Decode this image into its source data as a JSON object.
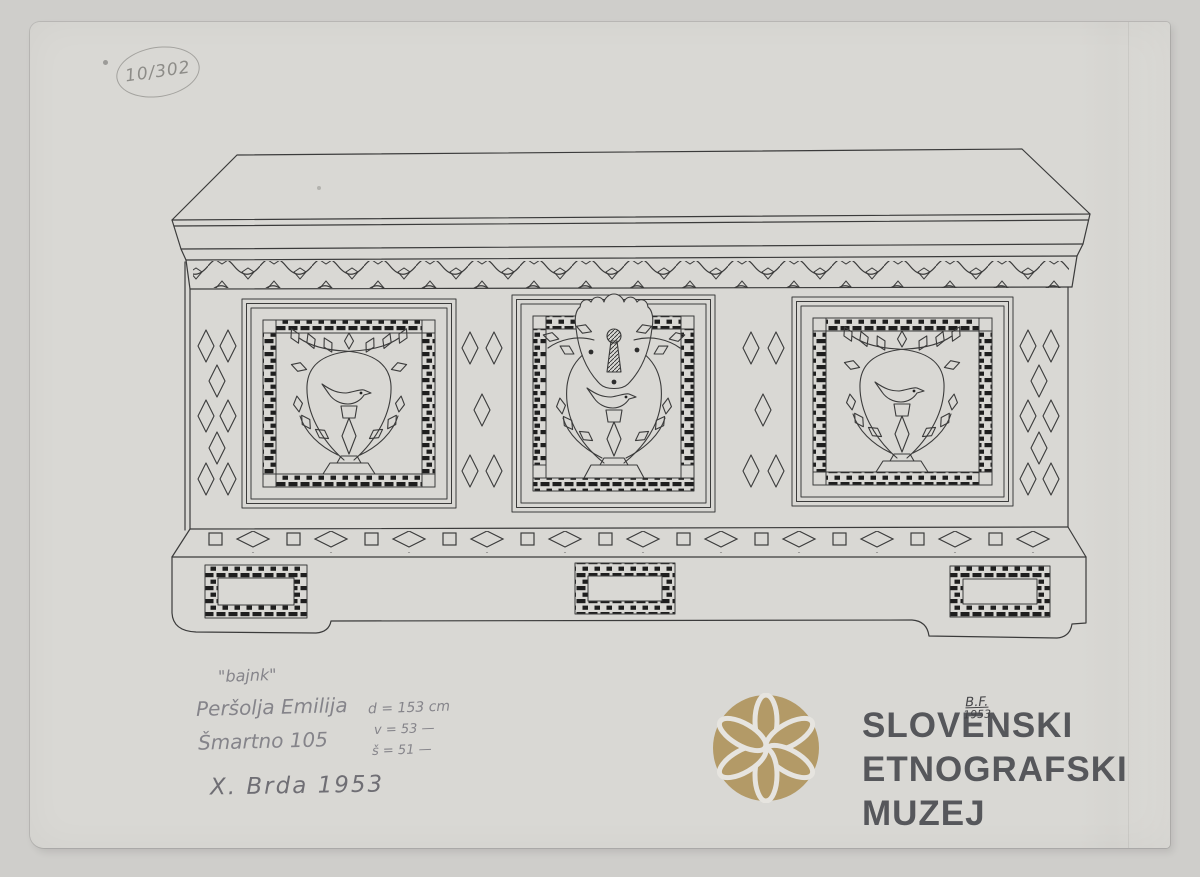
{
  "page": {
    "background": "#cfcecb",
    "paper_color": "#d9d8d4"
  },
  "archive_number": "10/302",
  "handwritten": {
    "object_name": "\"bajnk\"",
    "owner": "Peršolja Emilija",
    "address": "Šmartno 105",
    "dim_length": "d = 153 cm",
    "dim_height": "v = 53 —",
    "dim_width": "š = 51 —",
    "region_year": "X. Brda 1953",
    "initials": "B.F.",
    "initials_year": "1953",
    "pencil_color": "#85848a"
  },
  "logo": {
    "line1": "SLOVENSKI",
    "line2": "ETNOGRAFSKI",
    "line3": "MUZEJ",
    "gold": "#b39a67",
    "text_color": "#56575b",
    "petal_outline": "#e6e4df"
  },
  "drawing": {
    "ink_color": "#3b3b3b",
    "motifs": {
      "frieze": "vine-wave-with-leaves",
      "left_panel": "bird-under-crossed-branches",
      "center_panel": "bird-under-arch-with-keyhole-escutcheon",
      "right_panel": "bird-under-crossed-branches",
      "rail": "alternating-diamonds-and-squares",
      "plinth": "three-mosaic-rectangles"
    }
  }
}
